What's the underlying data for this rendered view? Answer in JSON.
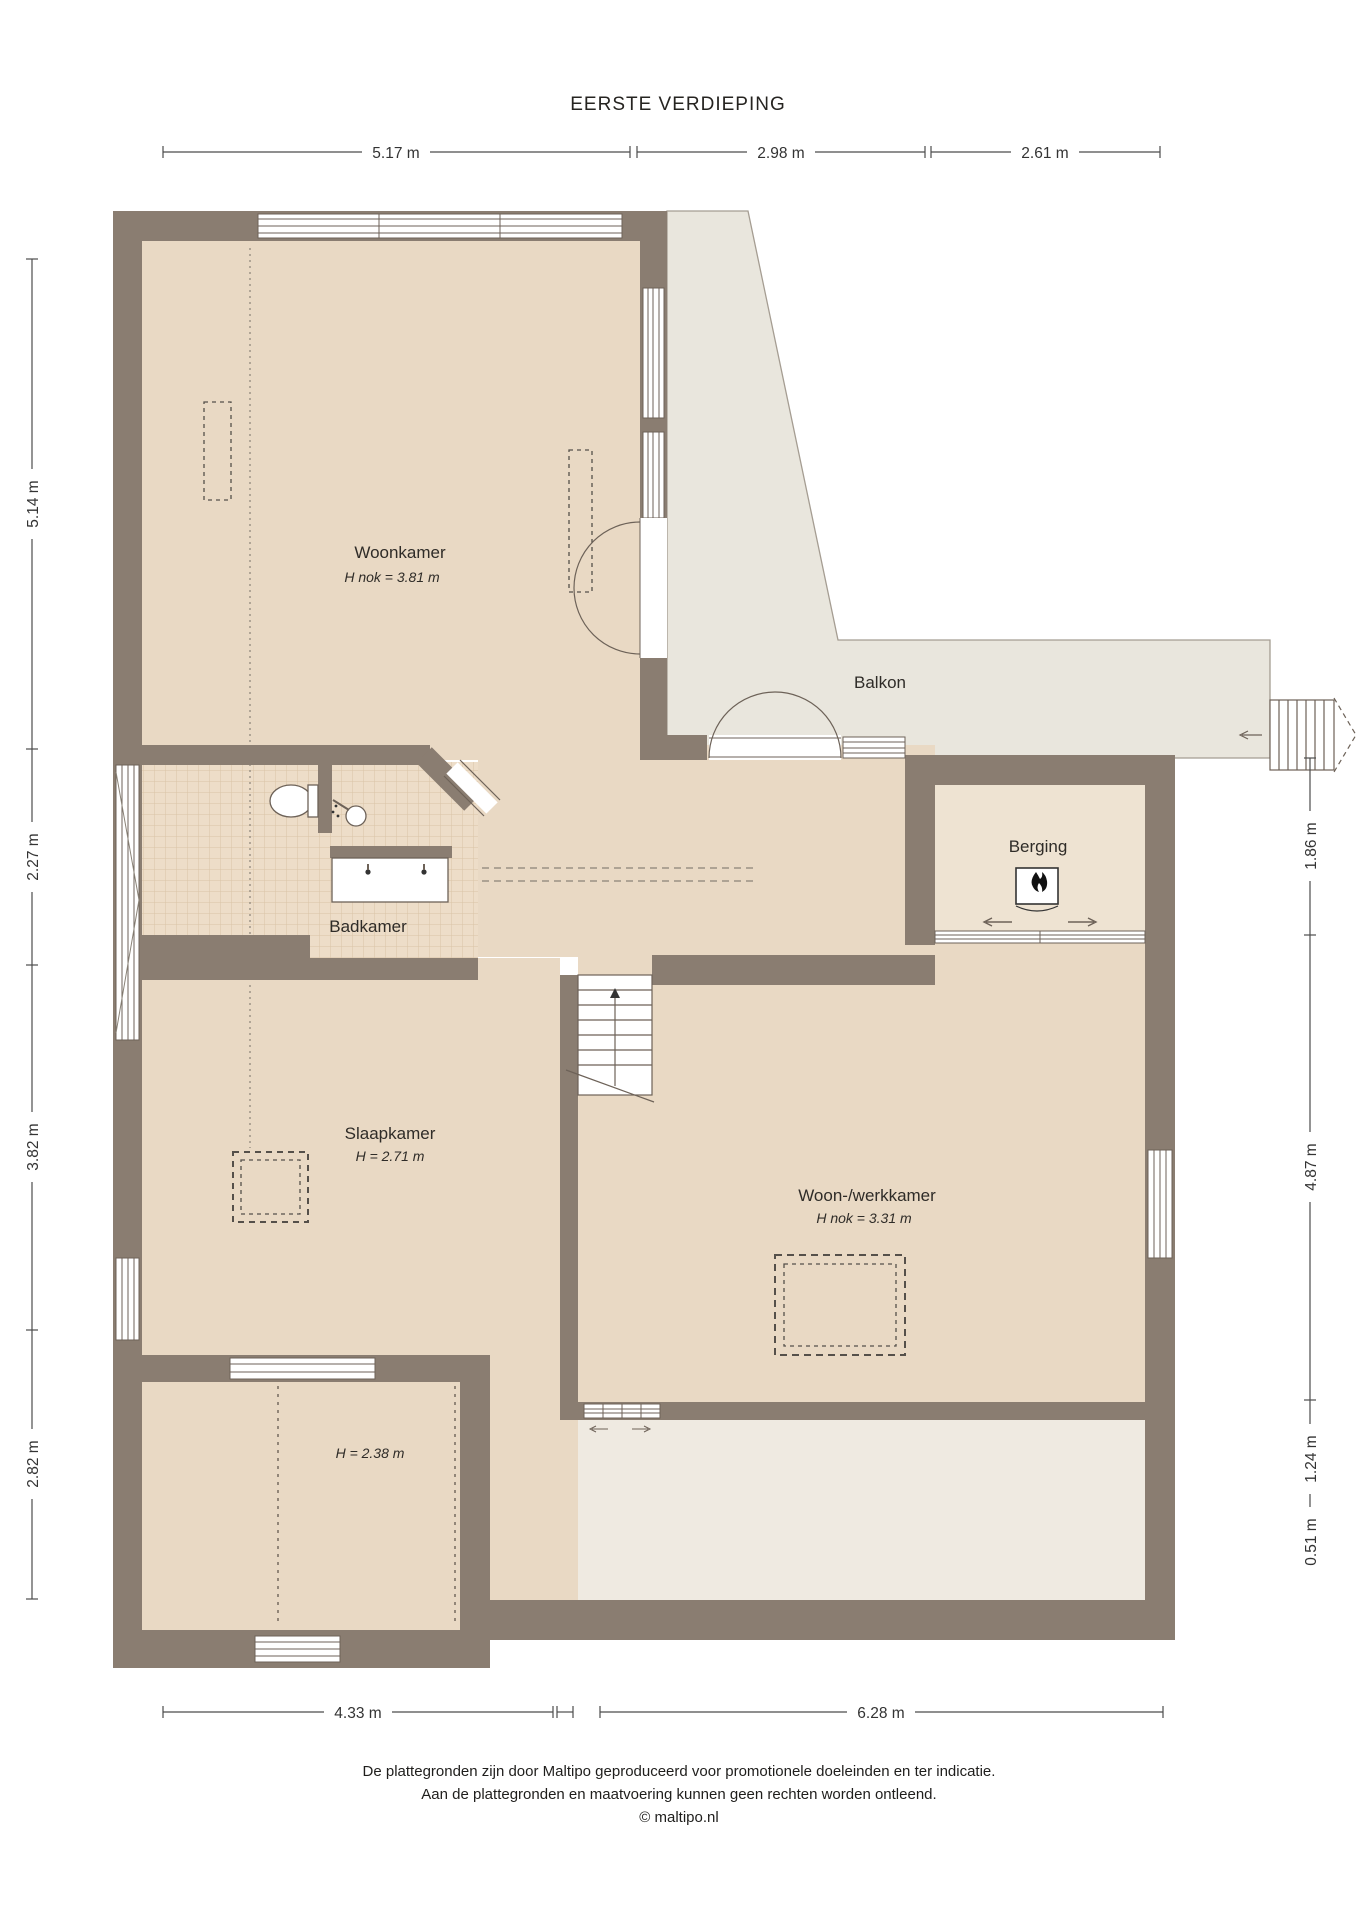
{
  "title": "EERSTE VERDIEPING",
  "rooms": {
    "woonkamer": {
      "label": "Woonkamer",
      "height": "H nok = 3.81 m"
    },
    "balkon": {
      "label": "Balkon"
    },
    "berging": {
      "label": "Berging"
    },
    "badkamer": {
      "label": "Badkamer"
    },
    "slaapkamer": {
      "label": "Slaapkamer",
      "height": "H = 2.71 m"
    },
    "woonwerkkamer": {
      "label": "Woon-/werkkamer",
      "height": "H nok = 3.31 m"
    },
    "kamer_linksonder": {
      "height": "H = 2.38 m"
    }
  },
  "dimensions": {
    "top": [
      {
        "label": "5.17 m"
      },
      {
        "label": "2.98 m"
      },
      {
        "label": "2.61 m"
      }
    ],
    "left": [
      {
        "label": "5.14 m"
      },
      {
        "label": "2.27 m"
      },
      {
        "label": "3.82 m"
      },
      {
        "label": "2.82 m"
      }
    ],
    "right": [
      {
        "label": "1.86 m"
      },
      {
        "label": "4.87 m"
      },
      {
        "label": "1.24 m"
      },
      {
        "label": "0.51 m"
      }
    ],
    "bottom": [
      {
        "label": "4.33 m"
      },
      {
        "label": "6.28 m"
      }
    ]
  },
  "footer": {
    "line1": "De plattegronden zijn door Maltipo geproduceerd voor promotionele doeleinden en ter indicatie.",
    "line2": "Aan de plattegronden en maatvoering kunnen geen rechten worden ontleend.",
    "line3": "© maltipo.nl"
  },
  "colors": {
    "wall": "#8a7d71",
    "floor": "#e9d9c4",
    "balkon": "#e9e6dd",
    "berging": "#eee3d2",
    "roof_strip": "#efeae1",
    "tile": "#edddc8"
  }
}
